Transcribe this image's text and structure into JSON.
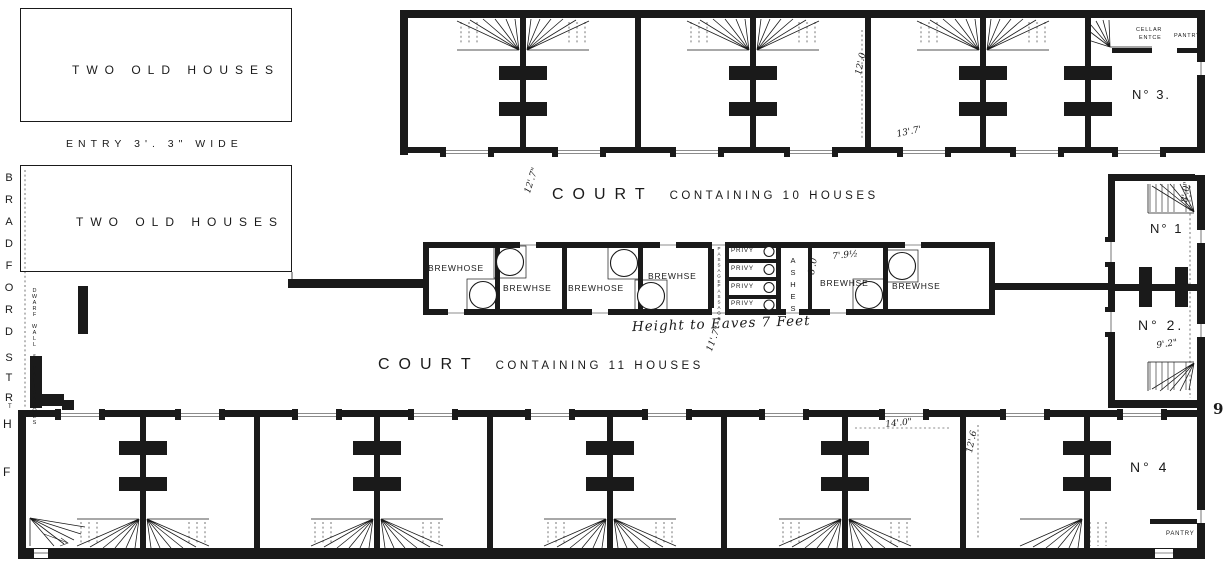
{
  "colors": {
    "ink": "#1a1a1a",
    "paper": "#ffffff"
  },
  "plan": {
    "street": {
      "b": "BRADFORD",
      "s": "STR",
      "t": "T",
      "h": "H",
      "f": "F"
    },
    "left_blocks": {
      "house1": "TWO OLD HOUSES",
      "entry": "ENTRY 3'. 3\" WIDE",
      "house2": "TWO OLD HOUSES",
      "boundary": "DWARF WALL & PALISADOES"
    },
    "courts": {
      "upper_word": "COURT",
      "upper_rest": "CONTAINING 10 HOUSES",
      "lower_word": "COURT",
      "lower_rest": "CONTAINING 11 HOUSES",
      "eaves_note": "Height to Eaves 7 Feet"
    },
    "middle_range": {
      "brewhouses": [
        {
          "label": "BREWHOSE"
        },
        {
          "label": "BREWHSE"
        },
        {
          "label": "BREWHOSE"
        },
        {
          "label": "BREWHSE"
        },
        {
          "label": "BREWHSE"
        },
        {
          "label": "BREWHSE"
        }
      ],
      "privies": [
        {
          "label": "PRIVY"
        },
        {
          "label": "PRIVY"
        },
        {
          "label": "PRIVY"
        },
        {
          "label": "PRIVY"
        }
      ],
      "passages": [
        {
          "label": "PASSAGE"
        },
        {
          "label": "PASSAGE"
        }
      ],
      "ashes": "ASHES"
    },
    "rooms": {
      "no1": "N° 1",
      "no2": "N° 2.",
      "no3": "N° 3.",
      "no4": "N° 4",
      "cellar_line1": "CELLAR",
      "cellar_line2": "ENTCE",
      "pantry_top": "PANTRY",
      "pantry_bottom": "PANTRY"
    },
    "dimensions": [
      {
        "text": "12'.7\""
      },
      {
        "text": "12'.0"
      },
      {
        "text": "13'.7'"
      },
      {
        "text": "7'.9½"
      },
      {
        "text": "8'.0"
      },
      {
        "text": "8'.0\""
      },
      {
        "text": "10'.0"
      },
      {
        "text": "9'.2\""
      },
      {
        "text": "11'.7\""
      },
      {
        "text": "14'.0\""
      },
      {
        "text": "12'.6"
      }
    ],
    "page_mark": "9"
  }
}
